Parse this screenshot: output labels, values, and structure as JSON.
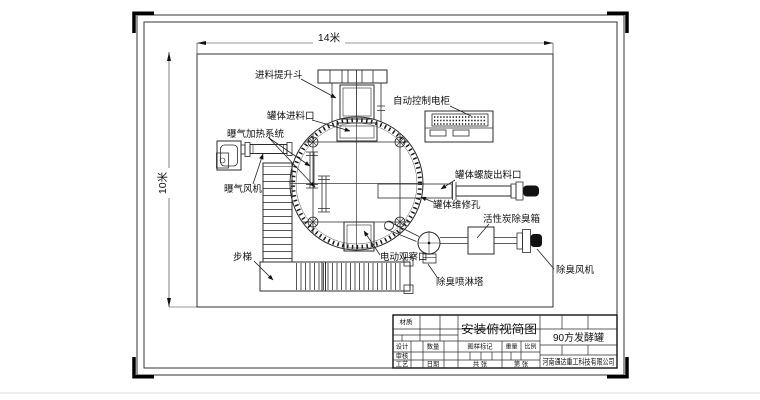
{
  "drawing": {
    "dim_width": "14米",
    "dim_height": "10米",
    "labels": {
      "feed_hopper": "进料提升斗",
      "tank_inlet": "罐体进料口",
      "aeration_heating": "曝气加热系统",
      "aeration_fan": "曝气风机",
      "control_cabinet": "自动控制电柜",
      "screw_outlet": "罐体螺旋出料口",
      "maintenance_hole": "罐体维修孔",
      "carbon_box": "活性炭除臭箱",
      "deodorize_fan": "除臭风机",
      "observation_port": "电动观察口",
      "spray_tower": "除臭喷淋塔",
      "stairs": "步梯"
    }
  },
  "title_block": {
    "material": "材质",
    "title": "安装俯视简图",
    "product": "90方发酵罐",
    "design": "设计",
    "quantity": "数量",
    "mark": "图样标记",
    "weight": "重量",
    "scale": "比例",
    "review": "审核",
    "process": "工艺",
    "date": "日期",
    "total_sheets": "共  张",
    "sheet_no": "第  张",
    "company": "河南通达重工科技有限公司"
  }
}
